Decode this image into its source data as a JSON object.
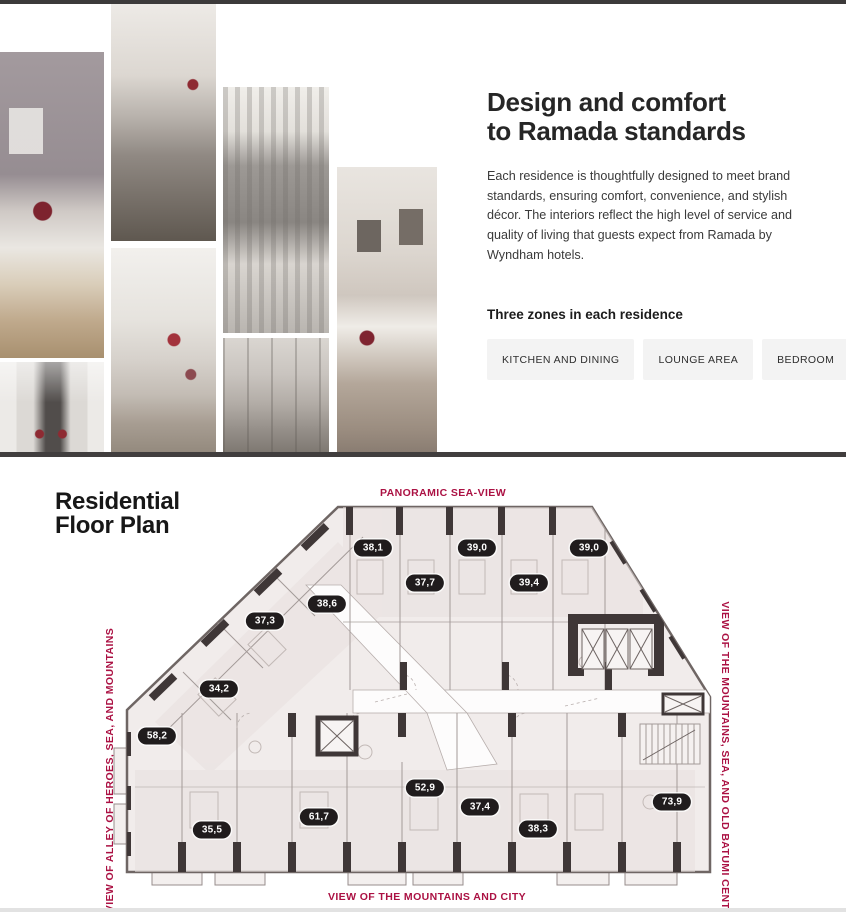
{
  "theme": {
    "accent_red": "#ab1143",
    "pill_background": "#201c1d",
    "pill_text": "#ffffff",
    "divider_dark": "#3e3b3b",
    "button_background": "#f3f3f3"
  },
  "intro": {
    "heading_line1": "Design and comfort",
    "heading_line2": "to Ramada standards",
    "paragraph": "Each residence is thoughtfully designed to meet brand standards, ensuring comfort, convenience, and stylish décor. The interiors reflect the high level of service and quality of living that guests expect from Ramada by Wyndham hotels.",
    "zones_heading": "Three zones in each residence",
    "zone_buttons": [
      {
        "label": "KITCHEN AND DINING"
      },
      {
        "label": "LOUNGE AREA"
      },
      {
        "label": "BEDROOM"
      }
    ]
  },
  "collage": {
    "photos": [
      {
        "name": "living-room-photo"
      },
      {
        "name": "kitchen-photo"
      },
      {
        "name": "kitchen-dining-photo"
      },
      {
        "name": "lounge-photo"
      },
      {
        "name": "dining-area-photo"
      },
      {
        "name": "bathroom-photo"
      },
      {
        "name": "bedroom-photo"
      }
    ]
  },
  "floor_plan": {
    "heading_line1": "Residential",
    "heading_line2": "Floor Plan",
    "views": {
      "top": "PANORAMIC SEA-VIEW",
      "left": "VIEW OF ALLEY OF HEROES, SEA, AND MOUNTAINS",
      "right": "VIEW OF THE MOUNTAINS, SEA, AND OLD BATUMI CENTER",
      "bottom": "VIEW OF THE MOUNTAINS AND CITY"
    },
    "units": [
      {
        "area": "38,1",
        "x": 278,
        "y": 46
      },
      {
        "area": "39,0",
        "x": 382,
        "y": 46
      },
      {
        "area": "39,0",
        "x": 494,
        "y": 46
      },
      {
        "area": "37,7",
        "x": 330,
        "y": 81
      },
      {
        "area": "39,4",
        "x": 434,
        "y": 81
      },
      {
        "area": "38,6",
        "x": 232,
        "y": 102
      },
      {
        "area": "37,3",
        "x": 170,
        "y": 119
      },
      {
        "area": "34,2",
        "x": 124,
        "y": 187
      },
      {
        "area": "58,2",
        "x": 62,
        "y": 234
      },
      {
        "area": "52,9",
        "x": 330,
        "y": 286
      },
      {
        "area": "37,4",
        "x": 385,
        "y": 305
      },
      {
        "area": "61,7",
        "x": 224,
        "y": 315
      },
      {
        "area": "35,5",
        "x": 117,
        "y": 328
      },
      {
        "area": "38,3",
        "x": 443,
        "y": 327
      },
      {
        "area": "73,9",
        "x": 577,
        "y": 300
      }
    ]
  }
}
